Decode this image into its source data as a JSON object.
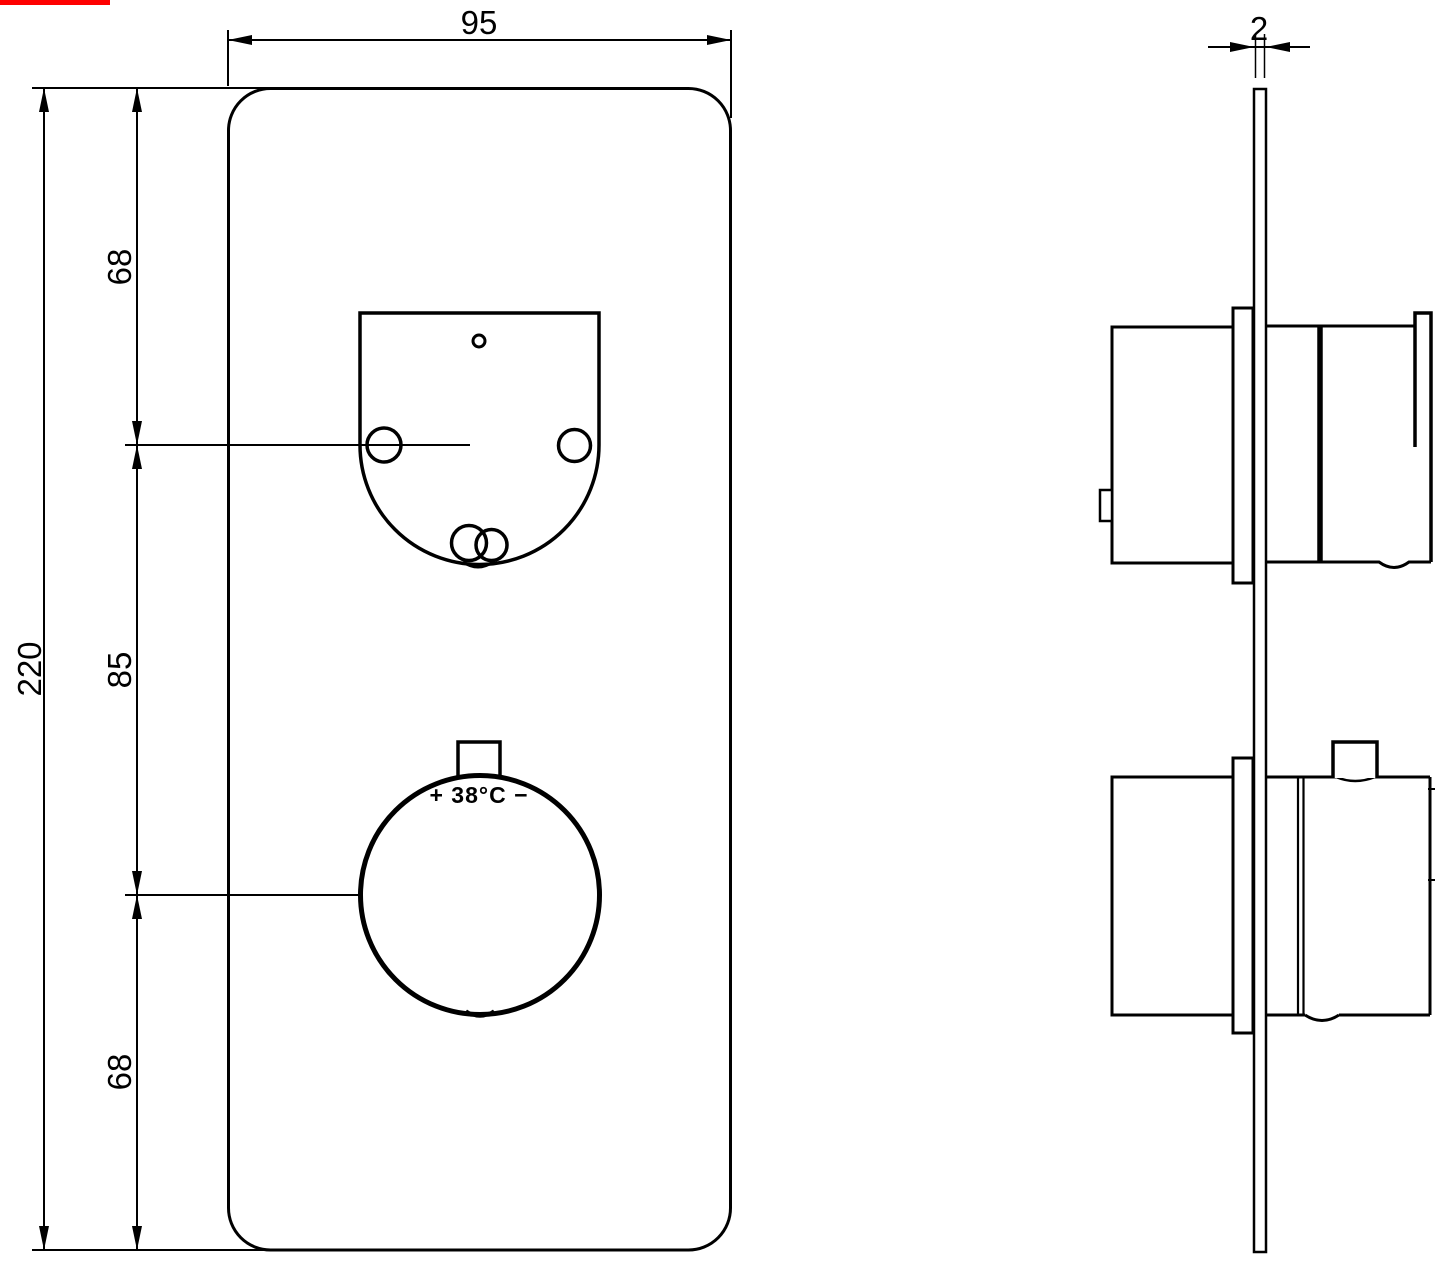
{
  "drawing": {
    "kind": "thermostatic-concealed-valve-installation-drawing",
    "dimensions": {
      "front_width": "95",
      "front_height": "220",
      "segment_top": "68",
      "segment_middle": "85",
      "segment_bottom": "68",
      "plate_thickness": "2"
    },
    "markings": {
      "temperature": "+ 38°C −"
    },
    "colors": {
      "line": "#000000",
      "background": "#ffffff",
      "accent_red": "#fe0000"
    }
  }
}
